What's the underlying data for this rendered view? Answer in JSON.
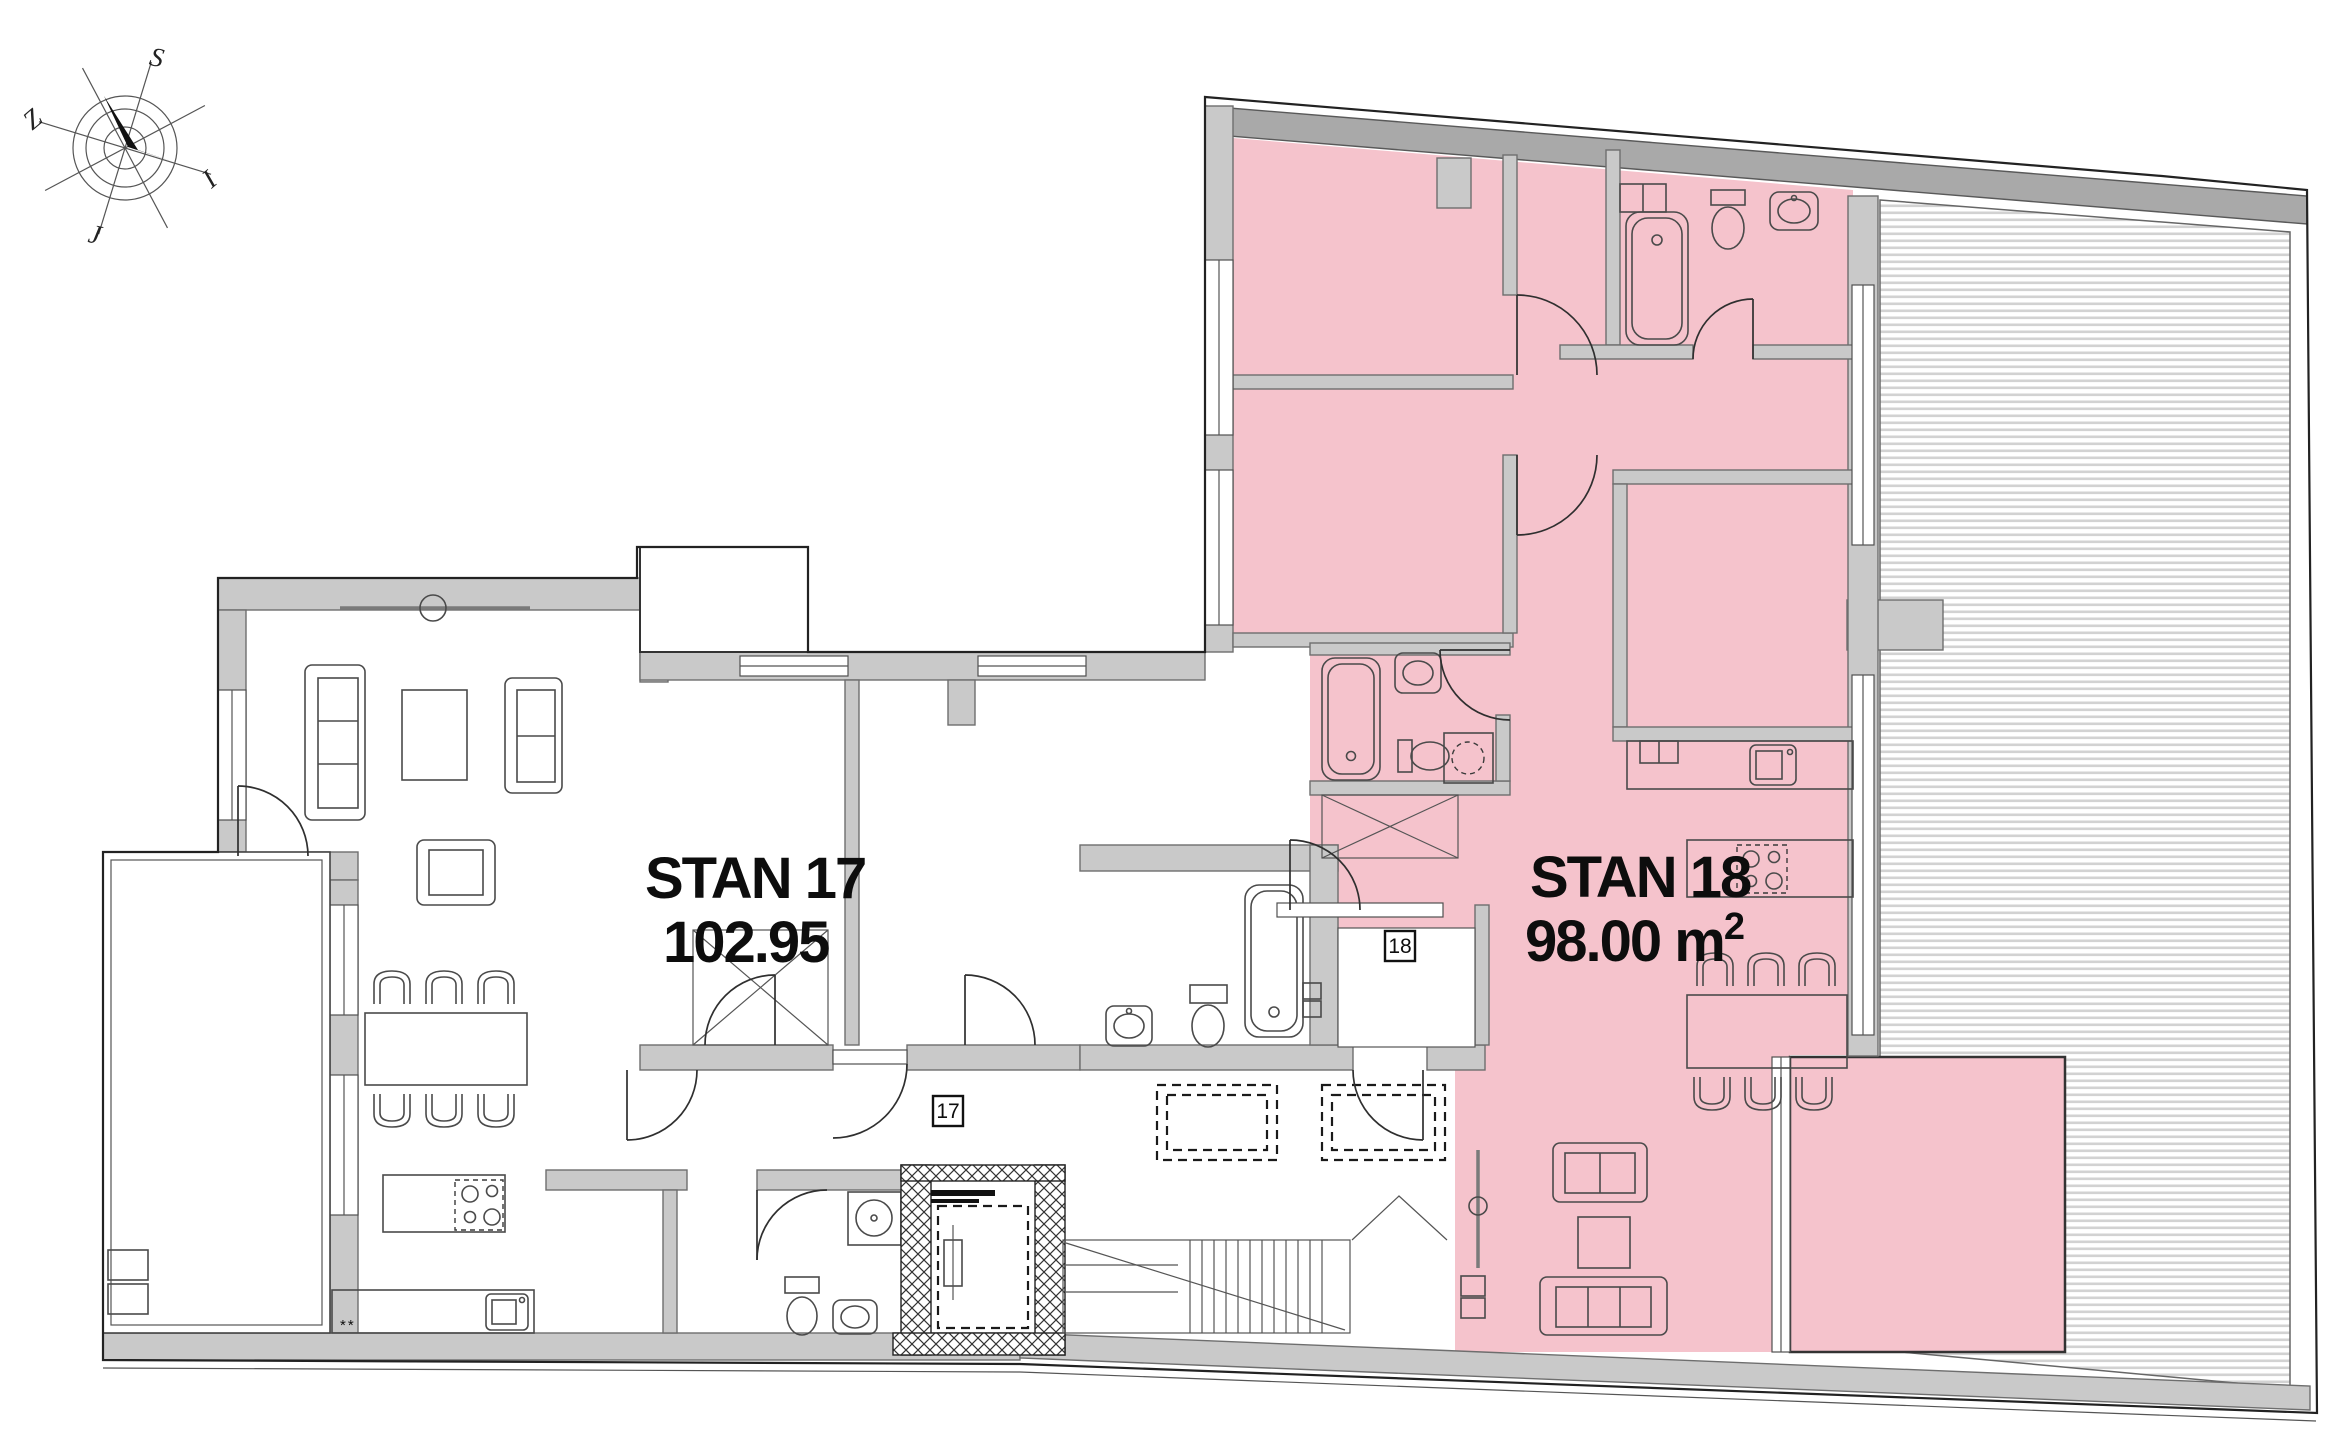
{
  "compass": {
    "north_label": "S",
    "west_label": "Z",
    "east_label": "I",
    "south_label": "J"
  },
  "apartments": [
    {
      "name": "STAN 17",
      "area_label": "102.95",
      "area_sup": "",
      "door_tag": "17",
      "highlighted": false
    },
    {
      "name": "STAN 18",
      "area_label": "98.00 m",
      "area_sup": "2",
      "door_tag": "18",
      "highlighted": true
    }
  ],
  "annotations": {
    "kitchen_note": "**"
  },
  "colors": {
    "highlight_pink": "#f5c3cc",
    "wall_gray": "#c9c9c9",
    "wall_dark_gray": "#a9a9a9",
    "outline_dark": "#222222",
    "hatch_gray": "#d2d2d2",
    "label_black": "#0d0d0d"
  }
}
